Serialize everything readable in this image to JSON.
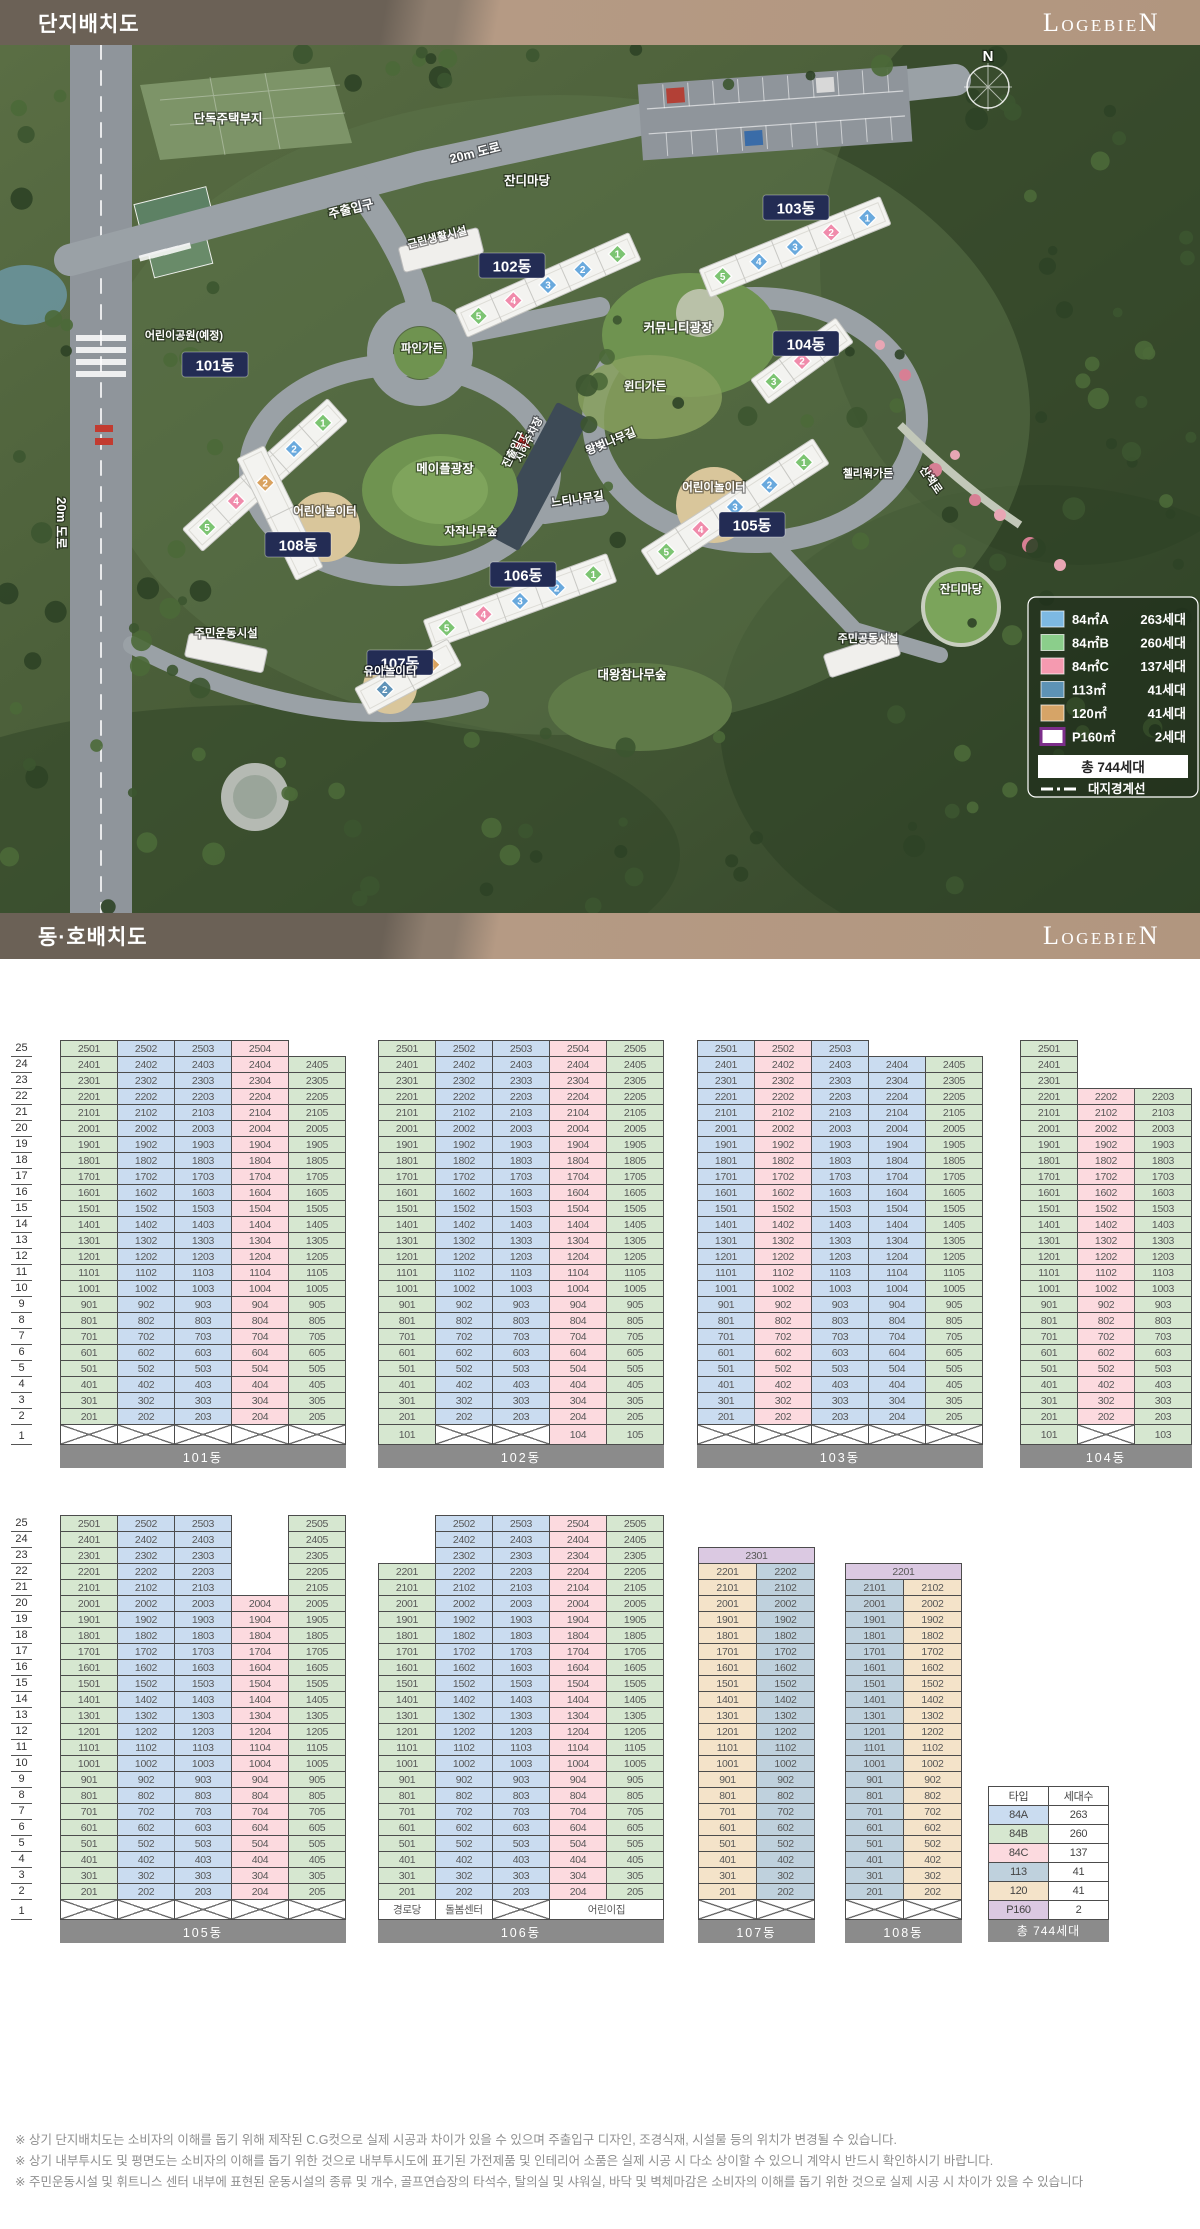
{
  "header1": {
    "title": "단지배치도",
    "brand": "LOGEBIEN"
  },
  "header2": {
    "title": "동·호배치도",
    "brand": "LOGEBIEN"
  },
  "site_plan": {
    "compass": "N",
    "legend": {
      "items": [
        {
          "label": "84㎡A",
          "count": "263세대",
          "color": "#7db9e2"
        },
        {
          "label": "84㎡B",
          "count": "260세대",
          "color": "#8bce8b"
        },
        {
          "label": "84㎡C",
          "count": "137세대",
          "color": "#f59ab0"
        },
        {
          "label": "113㎡",
          "count": "41세대",
          "color": "#5d93b5"
        },
        {
          "label": "120㎡",
          "count": "41세대",
          "color": "#d6a467"
        },
        {
          "label": "P160㎡",
          "count": "2세대",
          "color": "#ffffff",
          "border": "#7c2e8a"
        }
      ],
      "total": "총 744세대",
      "boundary_label": "대지경계선"
    },
    "labels": [
      {
        "text": "단독주택부지",
        "x": 228,
        "y": 78
      },
      {
        "text": "20m 도로",
        "x": 476,
        "y": 112,
        "rot": -14
      },
      {
        "text": "주출입구",
        "x": 352,
        "y": 168,
        "rot": -14
      },
      {
        "text": "잔디마당",
        "x": 527,
        "y": 140
      },
      {
        "text": "근린생활시설",
        "x": 438,
        "y": 196,
        "rot": -14,
        "size": 11
      },
      {
        "text": "어린이공원(예정)",
        "x": 184,
        "y": 294,
        "size": 11
      },
      {
        "text": "파인가든",
        "x": 422,
        "y": 307,
        "size": 11.5
      },
      {
        "text": "커뮤니티광장",
        "x": 678,
        "y": 287
      },
      {
        "text": "윈디가든",
        "x": 645,
        "y": 345,
        "size": 11.5
      },
      {
        "text": "왕벚나무길",
        "x": 612,
        "y": 400,
        "rot": -22,
        "size": 11.5
      },
      {
        "text": "어린이놀이터",
        "x": 714,
        "y": 446,
        "size": 11.5
      },
      {
        "text": "어린이놀이터",
        "x": 325,
        "y": 470,
        "size": 11.5
      },
      {
        "text": "메이플광장",
        "x": 445,
        "y": 428
      },
      {
        "text": "자작나무숲",
        "x": 471,
        "y": 490,
        "size": 11.5
      },
      {
        "text": "느티나무길",
        "x": 578,
        "y": 458,
        "rot": -8,
        "size": 11.5
      },
      {
        "text": "지하주차장",
        "x": 532,
        "y": 396,
        "rot": -64,
        "size": 10.5
      },
      {
        "text": "진출입구",
        "x": 517,
        "y": 406,
        "rot": -64,
        "size": 10.5
      },
      {
        "text": "첼리워가든",
        "x": 868,
        "y": 432,
        "size": 11
      },
      {
        "text": "산책로",
        "x": 928,
        "y": 437,
        "rot": 55,
        "size": 11
      },
      {
        "text": "20m 도로",
        "x": 57,
        "y": 478,
        "rot": 90
      },
      {
        "text": "주민운동시설",
        "x": 226,
        "y": 592,
        "size": 11.5
      },
      {
        "text": "유아놀이터",
        "x": 390,
        "y": 630,
        "size": 11.5
      },
      {
        "text": "대왕참나무숲",
        "x": 632,
        "y": 634
      },
      {
        "text": "잔디마당",
        "x": 961,
        "y": 548,
        "size": 11.5
      },
      {
        "text": "주민공동시설",
        "x": 868,
        "y": 597,
        "size": 11
      }
    ],
    "buildings": [
      {
        "name": "101동",
        "badge": {
          "x": 215,
          "y": 320
        },
        "slab": {
          "cx": 265,
          "cy": 430,
          "a": -42,
          "len": 195
        },
        "stacks": [
          "B",
          "A",
          "A",
          "C",
          "B"
        ]
      },
      {
        "name": "102동",
        "badge": {
          "x": 512,
          "y": 221
        },
        "slab": {
          "cx": 548,
          "cy": 240,
          "a": -24,
          "len": 190
        },
        "stacks": [
          "B",
          "A",
          "A",
          "C",
          "B"
        ]
      },
      {
        "name": "103동",
        "badge": {
          "x": 796,
          "y": 163
        },
        "slab": {
          "cx": 795,
          "cy": 202,
          "a": -22,
          "len": 195
        },
        "stacks": [
          "A",
          "C",
          "A",
          "A",
          "B"
        ]
      },
      {
        "name": "104동",
        "badge": {
          "x": 806,
          "y": 299
        },
        "slab": {
          "cx": 802,
          "cy": 316,
          "a": -36,
          "len": 105
        },
        "stacks": [
          "B",
          "C",
          "B"
        ]
      },
      {
        "name": "105동",
        "badge": {
          "x": 752,
          "y": 480
        },
        "slab": {
          "cx": 735,
          "cy": 462,
          "a": -33,
          "len": 205
        },
        "stacks": [
          "B",
          "A",
          "A",
          "C",
          "B"
        ]
      },
      {
        "name": "106동",
        "badge": {
          "x": 523,
          "y": 530
        },
        "slab": {
          "cx": 520,
          "cy": 556,
          "a": -20,
          "len": 195
        },
        "stacks": [
          "B",
          "A",
          "A",
          "C",
          "B"
        ]
      },
      {
        "name": "107동",
        "badge": {
          "x": 400,
          "y": 618
        },
        "slab": {
          "cx": 408,
          "cy": 632,
          "a": -28,
          "len": 105
        },
        "stacks": [
          "E",
          "D"
        ]
      },
      {
        "name": "108동",
        "badge": {
          "x": 298,
          "y": 500
        },
        "slab": {
          "cx": 280,
          "cy": 468,
          "a": 64,
          "len": 135
        },
        "stacks": [
          "D",
          "E"
        ]
      }
    ]
  },
  "unit_grid": {
    "axis_floors": [
      25,
      24,
      23,
      22,
      21,
      20,
      19,
      18,
      17,
      16,
      15,
      14,
      13,
      12,
      11,
      10,
      9,
      8,
      7,
      6,
      5,
      4,
      3,
      2,
      1
    ],
    "type_colors": {
      "A": "#cadcf0",
      "B": "#d6e7d0",
      "C": "#fcdadf",
      "D": "#bfd1dd",
      "E": "#f4e3c9",
      "P": "#dbc9e2"
    },
    "accent_colors": {
      "A": "#69a9dd",
      "B": "#7cc472",
      "C": "#f08bab",
      "D": "#5f93b8",
      "E": "#d9a25f",
      "P": "#7c2e8a"
    },
    "buildings": [
      {
        "id": "b101",
        "name": "101동",
        "cols": [
          "B",
          "A",
          "A",
          "C",
          "B"
        ],
        "top": 25,
        "absent": [
          {
            "c": 5,
            "f": [
              25
            ]
          }
        ],
        "floor1": [
          "x",
          "x",
          "x",
          "x",
          "x"
        ]
      },
      {
        "id": "b102",
        "name": "102동",
        "cols": [
          "B",
          "A",
          "A",
          "C",
          "B"
        ],
        "top": 25,
        "absent": [],
        "floor1": [
          {
            "v": "101",
            "t": "B"
          },
          "x",
          "x",
          {
            "v": "104",
            "t": "C"
          },
          {
            "v": "105",
            "t": "B"
          }
        ]
      },
      {
        "id": "b103",
        "name": "103동",
        "cols": [
          "A",
          "C",
          "A",
          "A",
          "B"
        ],
        "top": 25,
        "absent": [
          {
            "c": 4,
            "f": [
              25
            ]
          },
          {
            "c": 5,
            "f": [
              25
            ]
          }
        ],
        "floor1": [
          "x",
          "x",
          "x",
          "x",
          "x"
        ]
      },
      {
        "id": "b104",
        "name": "104동",
        "cols": [
          "B",
          "C",
          "B"
        ],
        "top": 25,
        "absent": [
          {
            "c": 2,
            "f": [
              25,
              24,
              23
            ]
          },
          {
            "c": 3,
            "f": [
              25,
              24,
              23
            ]
          }
        ],
        "floor1": [
          {
            "v": "101",
            "t": "B"
          },
          "x",
          {
            "v": "103",
            "t": "B"
          }
        ]
      },
      {
        "id": "b105",
        "name": "105동",
        "cols": [
          "B",
          "A",
          "A",
          "C",
          "B"
        ],
        "top": 25,
        "absent": [
          {
            "c": 4,
            "f": [
              25,
              24,
              23,
              22,
              21
            ]
          }
        ],
        "floor1": [
          "x",
          "x",
          "x",
          "x",
          "x"
        ]
      },
      {
        "id": "b106",
        "name": "106동",
        "cols": [
          "B",
          "A",
          "A",
          "C",
          "B"
        ],
        "top": 25,
        "absent": [
          {
            "c": 1,
            "f": [
              25,
              24,
              23
            ]
          }
        ],
        "floor1": [
          {
            "label": "경로당"
          },
          {
            "label": "돌봄센터"
          },
          "x",
          {
            "label": "어린이집",
            "span": 2
          }
        ]
      },
      {
        "id": "b107",
        "name": "107동",
        "cols": [
          "E",
          "D"
        ],
        "top": 22,
        "span_top": {
          "floor": 23,
          "v": "2301"
        },
        "absent": [],
        "floor1": [
          "x",
          "x"
        ]
      },
      {
        "id": "b108",
        "name": "108동",
        "cols": [
          "D",
          "E"
        ],
        "top": 21,
        "span_top": {
          "floor": 22,
          "v": "2201"
        },
        "absent": [],
        "floor1": [
          "x",
          "x"
        ]
      }
    ],
    "type_table": {
      "headers": [
        "타입",
        "세대수"
      ],
      "rows": [
        {
          "type": "84A",
          "count": "263",
          "t": "A"
        },
        {
          "type": "84B",
          "count": "260",
          "t": "B"
        },
        {
          "type": "84C",
          "count": "137",
          "t": "C"
        },
        {
          "type": "113",
          "count": "41",
          "t": "D"
        },
        {
          "type": "120",
          "count": "41",
          "t": "E"
        },
        {
          "type": "P160",
          "count": "2",
          "t": "P"
        }
      ],
      "total": "총 744세대"
    }
  },
  "footnotes": [
    "※ 상기 단지배치도는 소비자의 이해를 돕기 위해 제작된 C.G컷으로 실제 시공과 차이가 있을 수 있으며 주출입구 디자인, 조경식재, 시설물 등의 위치가 변경될 수 있습니다.",
    "※ 상기 내부투시도 및 평면도는 소비자의 이해를 돕기 위한 것으로 내부투시도에 표기된 가전제품 및 인테리어 소품은 실제 시공 시 다소 상이할 수 있으니 계약시 반드시 확인하시기 바랍니다.",
    "※ 주민운동시설 및 휘트니스 센터 내부에 표현된 운동시설의 종류 및 개수, 골프연습장의 타석수, 탈의실 및 샤워실, 바닥 및 벽체마감은 소비자의 이해를 돕기 위한 것으로 실제 시공 시 차이가 있을 수 있습니다"
  ]
}
